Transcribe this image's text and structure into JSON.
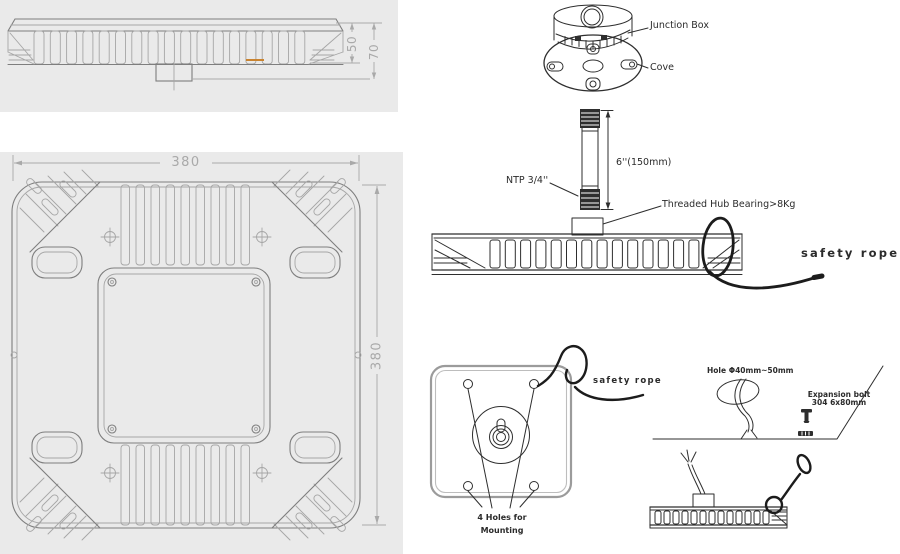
{
  "colors": {
    "paper": "#ffffff",
    "panel_bg": "#eaeaea",
    "cad_line": "#7e7e7e",
    "cad_light": "#a6a6a6",
    "dim_text": "#a9a9a9",
    "ink": "#2e2e2e",
    "label_text": "#2b2b2b",
    "accent_orange": "#c9832f"
  },
  "side_view": {
    "dim_fins": "50",
    "dim_total": "70"
  },
  "top_view": {
    "dim_width": "380",
    "dim_height": "380"
  },
  "labels": {
    "junction_box": "Junction Box",
    "cove": "Cove",
    "ntp": "NTP 3/4''",
    "pipe_length": "6''(150mm)",
    "hub_bearing": "Threaded Hub Bearing>8Kg",
    "safety_rope_side": "safety rope",
    "safety_rope_plate": "safety rope",
    "hole_size": "Hole Φ40mm~50mm",
    "expansion_bolt_1": "Expansion bolt",
    "expansion_bolt_2": "304 6x80mm",
    "mount_holes_1": "4 Holes  for",
    "mount_holes_2": "Mounting"
  }
}
